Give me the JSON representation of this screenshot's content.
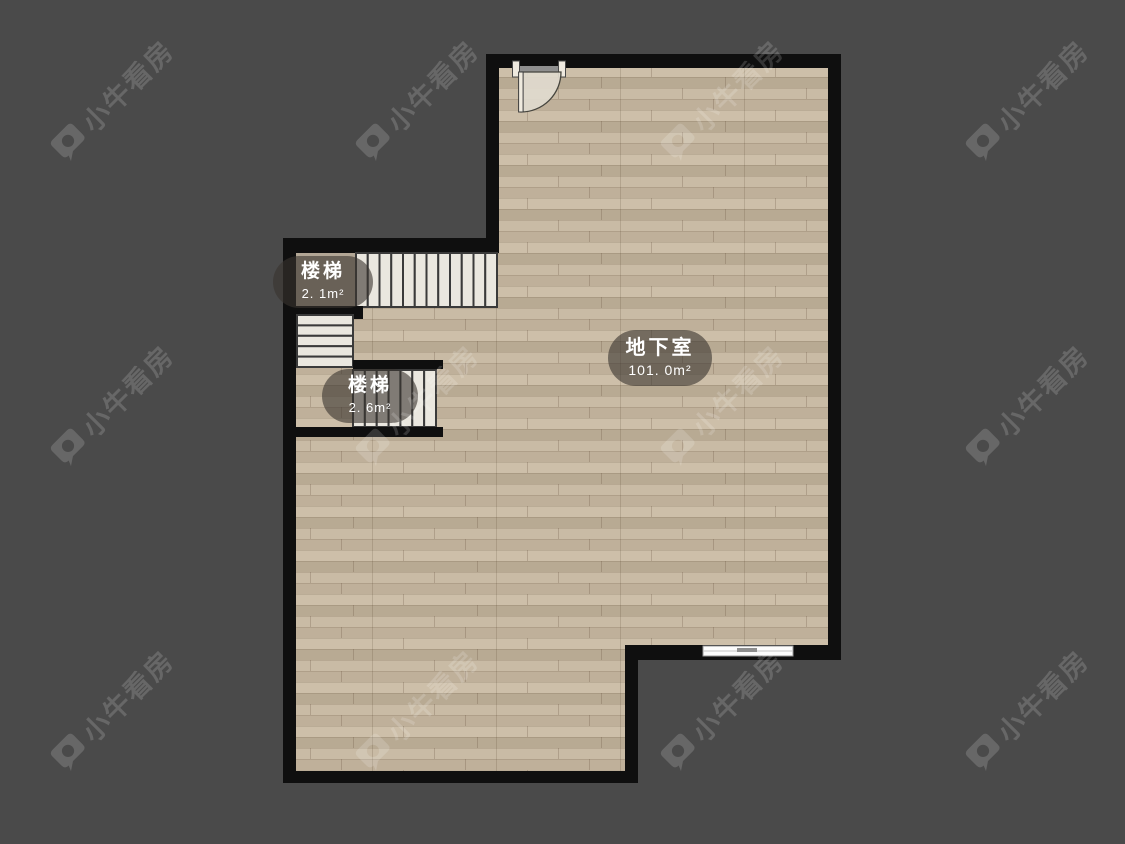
{
  "watermark": {
    "text": "小牛看房"
  },
  "rooms": [
    {
      "id": "stair-upper",
      "name": "楼梯",
      "area": "2. 1m²"
    },
    {
      "id": "stair-lower",
      "name": "楼梯",
      "area": "2. 6m²"
    },
    {
      "id": "basement",
      "name": "地下室",
      "area": "101. 0m²"
    }
  ],
  "colors": {
    "background": "#4a4a4a",
    "wall": "#0f0f0f",
    "floor_base": "#c3b49e",
    "tread": "#eae7df",
    "tread_border": "#3a3a3a",
    "label_bg": "rgba(56,52,46,0.60)",
    "label_text": "#ffffff",
    "watermark": "rgba(255,255,255,0.16)"
  }
}
